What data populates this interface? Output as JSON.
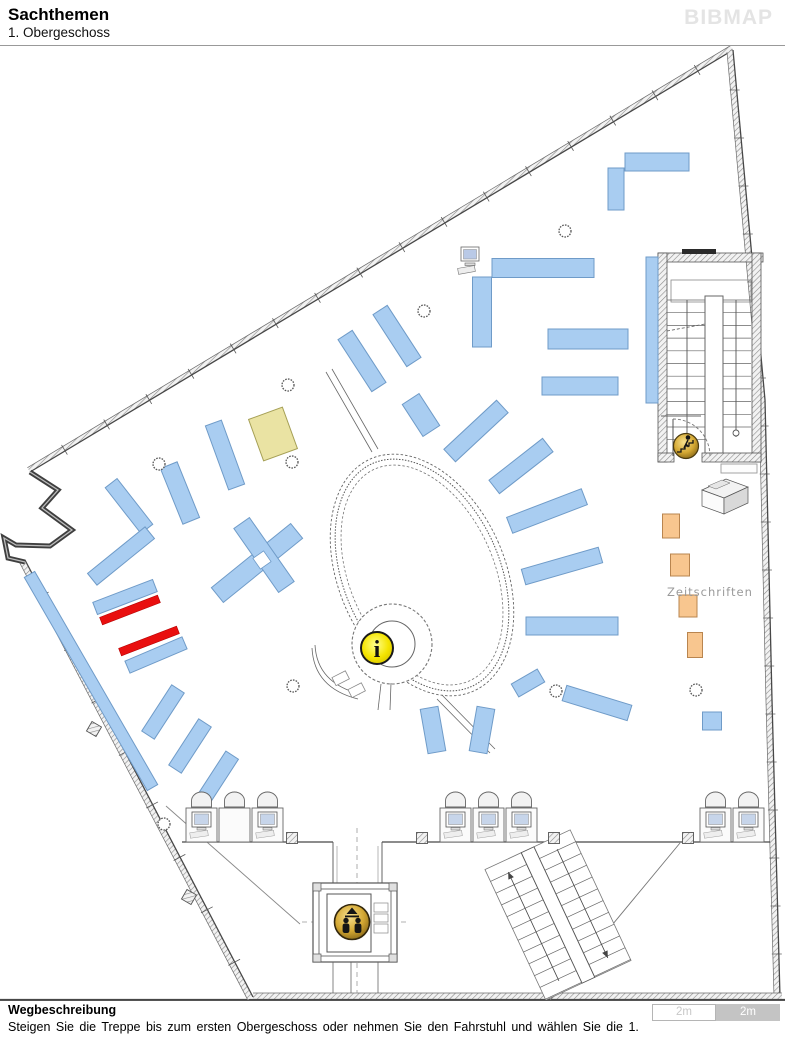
{
  "header": {
    "title": "Sachthemen",
    "subtitle": "1. Obergeschoss",
    "logo": "BIBMAP"
  },
  "footer": {
    "heading": "Wegbeschreibung",
    "text": "Steigen Sie die Treppe bis zum ersten Obergeschoss oder nehmen Sie den Fahrstuhl und wählen Sie die 1.",
    "scale": [
      "2m",
      "2m"
    ]
  },
  "map": {
    "zeitschriften_label": "Zeitschriften",
    "info_icon_glyph": "i",
    "colors": {
      "shelf_blue": "#A9CDF1",
      "shelf_blue_border": "#6F9BC8",
      "highlight_red": "#E90F0F",
      "highlight_red_border": "#B50000",
      "shelf_beige": "#EAE3A3",
      "shelf_beige_border": "#A59F55",
      "shelf_orange": "#F8C68F",
      "shelf_orange_border": "#B9854F",
      "wall_gray": "#474747",
      "label_gray": "#9A9A9A",
      "logo_gray": "#E4E4E4",
      "icon_gold": "#D4A833",
      "info_yellow": "#F4E400",
      "scale_left_text": "#C8C8C8",
      "scale_right_bg": "#C4C4C4"
    },
    "shelves": [
      {
        "cx": 657,
        "cy": 162,
        "w": 64,
        "h": 18,
        "rot": 0,
        "type": "blue"
      },
      {
        "cx": 616,
        "cy": 189,
        "w": 16,
        "h": 42,
        "rot": 0,
        "type": "blue"
      },
      {
        "cx": 543,
        "cy": 268,
        "w": 102,
        "h": 19,
        "rot": 0,
        "type": "blue"
      },
      {
        "cx": 482,
        "cy": 312,
        "w": 19,
        "h": 70,
        "rot": 0,
        "type": "blue"
      },
      {
        "cx": 588,
        "cy": 339,
        "w": 80,
        "h": 20,
        "rot": 0,
        "type": "blue"
      },
      {
        "cx": 580,
        "cy": 386,
        "w": 76,
        "h": 18,
        "rot": 0,
        "type": "blue"
      },
      {
        "cx": 362,
        "cy": 361,
        "w": 17,
        "h": 62,
        "rot": -33,
        "type": "blue"
      },
      {
        "cx": 397,
        "cy": 336,
        "w": 17,
        "h": 62,
        "rot": -33,
        "type": "blue"
      },
      {
        "cx": 421,
        "cy": 415,
        "w": 20,
        "h": 38,
        "rot": -33,
        "type": "blue"
      },
      {
        "cx": 652,
        "cy": 330,
        "w": 12,
        "h": 146,
        "rot": 0,
        "type": "blue"
      },
      {
        "cx": 476,
        "cy": 431,
        "w": 72,
        "h": 17,
        "rot": -43,
        "type": "blue"
      },
      {
        "cx": 521,
        "cy": 466,
        "w": 68,
        "h": 17,
        "rot": -38,
        "type": "blue"
      },
      {
        "cx": 547,
        "cy": 511,
        "w": 80,
        "h": 17,
        "rot": -21,
        "type": "blue"
      },
      {
        "cx": 562,
        "cy": 566,
        "w": 80,
        "h": 16,
        "rot": -16,
        "type": "blue"
      },
      {
        "cx": 572,
        "cy": 626,
        "w": 92,
        "h": 18,
        "rot": 0,
        "type": "blue"
      },
      {
        "cx": 528,
        "cy": 683,
        "w": 30,
        "h": 15,
        "rot": -30,
        "type": "blue"
      },
      {
        "cx": 597,
        "cy": 703,
        "w": 68,
        "h": 16,
        "rot": 17,
        "type": "blue"
      },
      {
        "cx": 433,
        "cy": 730,
        "w": 18,
        "h": 45,
        "rot": -10,
        "type": "blue"
      },
      {
        "cx": 482,
        "cy": 730,
        "w": 18,
        "h": 45,
        "rot": 10,
        "type": "blue"
      },
      {
        "cx": 712,
        "cy": 721,
        "w": 19,
        "h": 18,
        "rot": 0,
        "type": "blue"
      },
      {
        "cx": 180,
        "cy": 493,
        "w": 18,
        "h": 60,
        "rot": -22,
        "type": "blue"
      },
      {
        "cx": 129,
        "cy": 506,
        "w": 15,
        "h": 58,
        "rot": -38,
        "type": "blue"
      },
      {
        "cx": 121,
        "cy": 556,
        "w": 74,
        "h": 15,
        "rot": -39,
        "type": "blue"
      },
      {
        "cx": 225,
        "cy": 455,
        "w": 17,
        "h": 68,
        "rot": -20,
        "type": "blue"
      },
      {
        "cx": 257,
        "cy": 563,
        "w": 102,
        "h": 19,
        "rot": -39,
        "type": "blue"
      },
      {
        "cx": 264,
        "cy": 555,
        "w": 19,
        "h": 78,
        "rot": -35,
        "type": "blue"
      },
      {
        "cx": 125,
        "cy": 597,
        "w": 64,
        "h": 13,
        "rot": -21,
        "type": "blue"
      },
      {
        "cx": 156,
        "cy": 655,
        "w": 62,
        "h": 13,
        "rot": -23,
        "type": "blue"
      },
      {
        "cx": 163,
        "cy": 712,
        "w": 15,
        "h": 55,
        "rot": 33,
        "type": "blue"
      },
      {
        "cx": 190,
        "cy": 746,
        "w": 15,
        "h": 55,
        "rot": 33,
        "type": "blue"
      },
      {
        "cx": 218,
        "cy": 777,
        "w": 15,
        "h": 52,
        "rot": 33,
        "type": "blue"
      },
      {
        "cx": 91,
        "cy": 681,
        "w": 12,
        "h": 246,
        "rot": -30,
        "type": "blue"
      },
      {
        "cx": 130,
        "cy": 610,
        "w": 62,
        "h": 8,
        "rot": -21,
        "type": "red"
      },
      {
        "cx": 149,
        "cy": 641,
        "w": 62,
        "h": 8,
        "rot": -21,
        "type": "red"
      },
      {
        "cx": 273,
        "cy": 434,
        "w": 36,
        "h": 44,
        "rot": -20,
        "type": "beige"
      },
      {
        "cx": 671,
        "cy": 526,
        "w": 17,
        "h": 24,
        "rot": 0,
        "type": "orange"
      },
      {
        "cx": 680,
        "cy": 565,
        "w": 19,
        "h": 22,
        "rot": 0,
        "type": "orange"
      },
      {
        "cx": 688,
        "cy": 606,
        "w": 18,
        "h": 22,
        "rot": 0,
        "type": "orange"
      },
      {
        "cx": 695,
        "cy": 645,
        "w": 15,
        "h": 25,
        "rot": 0,
        "type": "orange"
      }
    ],
    "columns": [
      [
        565,
        231
      ],
      [
        424,
        311
      ],
      [
        288,
        385
      ],
      [
        159,
        464
      ],
      [
        292,
        462
      ],
      [
        293,
        686
      ],
      [
        556,
        691
      ],
      [
        696,
        690
      ],
      [
        164,
        824
      ]
    ],
    "posts": [
      [
        292,
        838,
        0
      ],
      [
        422,
        838,
        0
      ],
      [
        554,
        838,
        0
      ],
      [
        688,
        838,
        0
      ],
      [
        94,
        729,
        30
      ],
      [
        189,
        897,
        30
      ]
    ],
    "station_groups": [
      {
        "x": 186,
        "monitors": [
          true,
          false,
          true
        ]
      },
      {
        "x": 440,
        "monitors": [
          true,
          true,
          true
        ]
      },
      {
        "x": 700,
        "monitors": [
          true,
          true
        ]
      }
    ]
  }
}
